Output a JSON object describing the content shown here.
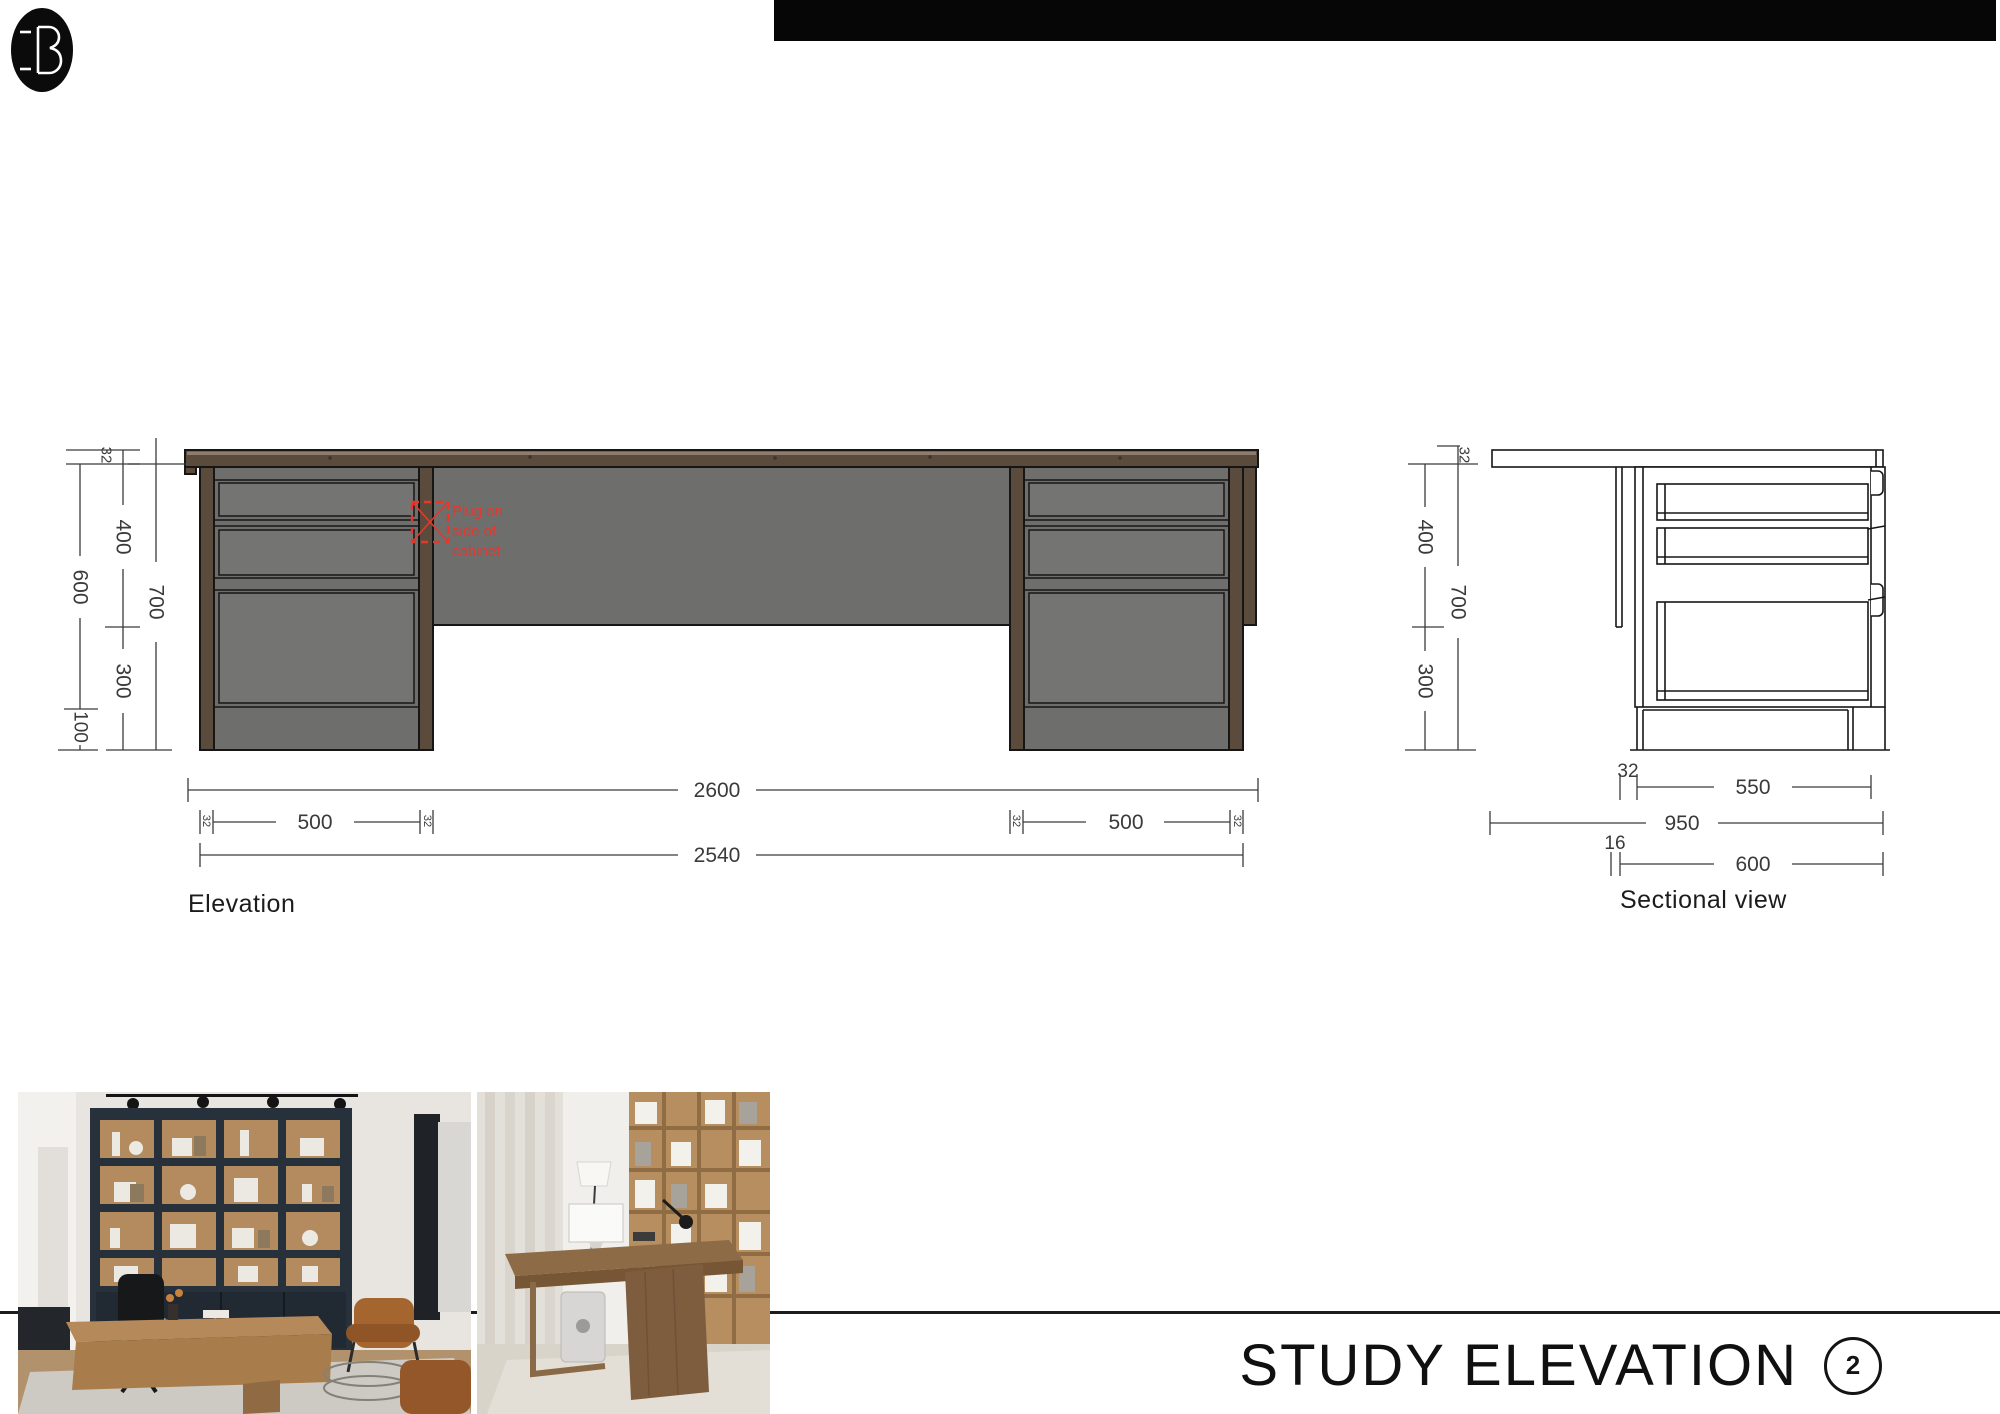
{
  "page": {
    "title": "STUDY ELEVATION",
    "page_number": "2"
  },
  "drawings": {
    "elevation": {
      "label": "Elevation",
      "annotation": [
        "Plug on",
        "side of",
        "cabinet"
      ]
    },
    "section": {
      "label": "Sectional view"
    },
    "dims": {
      "d16": "16",
      "d32": "32",
      "d100": "100",
      "d300": "300",
      "d400": "400",
      "d500": "500",
      "d550": "550",
      "d600": "600",
      "d700": "700",
      "d950": "950",
      "d2540": "2540",
      "d2600": "2600"
    }
  }
}
